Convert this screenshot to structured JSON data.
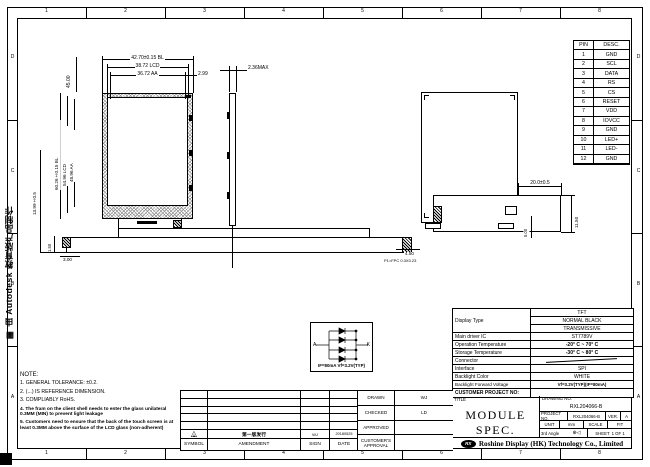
{
  "watermark": {
    "icon": "▦",
    "text": "由 Autodesk 教育版产品制作"
  },
  "zones": {
    "cols": [
      "1",
      "2",
      "3",
      "4",
      "5",
      "6",
      "7",
      "8"
    ],
    "rows": [
      "D",
      "C",
      "B",
      "A"
    ]
  },
  "pin_table": {
    "header": [
      "PIN",
      "DESC."
    ],
    "rows": [
      [
        "1",
        "GND"
      ],
      [
        "2",
        "SCL"
      ],
      [
        "3",
        "DATA"
      ],
      [
        "4",
        "RS"
      ],
      [
        "5",
        "CS"
      ],
      [
        "6",
        "RESET"
      ],
      [
        "7",
        "VDD"
      ],
      [
        "8",
        "IOVCC"
      ],
      [
        "9",
        "GND"
      ],
      [
        "10",
        "LED+"
      ],
      [
        "11",
        "LED-"
      ],
      [
        "12",
        "GND"
      ]
    ]
  },
  "dims": {
    "front_top_bl": "42.70±0.15 BL",
    "front_top_lcd": "38.72 LCD",
    "front_top_aa": "36.72 AA",
    "front_right_offset": "2.99",
    "front_topleft": "45.00",
    "front_left_bl": "60.26±0.15 BL",
    "front_left_lcd": "54.96 LCD",
    "front_left_aa": "48.96 AA",
    "front_farleft": "13.99±0.5",
    "fpc_150": "1.50",
    "fpc_300": "3.00",
    "side_thickness": "2.36MAX",
    "fpc_width": "4.50",
    "fpc_note": "P1=FPC 0.3X0.23",
    "back_tail_len": "20.0±0.5",
    "back_tail_w": "11.50",
    "back_foot": "5.00"
  },
  "circuit": {
    "anode": "A",
    "cathode": "K",
    "label": "IF=80mA  Vf=3.2V(TYP)"
  },
  "spec_table": {
    "display_type_label": "Display Type",
    "display_type_values": [
      "TFT",
      "NORMAL BLACK",
      "TRANSMISSIVE"
    ],
    "rows": [
      {
        "label": "Main driver IC",
        "value": "ST7789V"
      },
      {
        "label": "Operation Temperature",
        "value": "-20° C ~ 70° C"
      },
      {
        "label": "Storage Temperature",
        "value": "-30° C ~ 80° C"
      },
      {
        "label": "Connector",
        "value": ""
      },
      {
        "label": "Interface",
        "value": "SPI"
      },
      {
        "label": "Backlight Color",
        "value": "WHITE"
      },
      {
        "label": "Backlight Forward Voltage",
        "value": "Vf=3.2V(TYP)(IF=80mA)"
      }
    ],
    "customer_project_label": "CUSTOMER PROJECT NO:"
  },
  "title_block": {
    "title_label": "TITLE",
    "title": "MODULE SPEC.",
    "drawing_no_label": "DRAWING NO.",
    "drawing_no": "RXL204066-B",
    "project_no_label": "PROJECT NO.",
    "project_no": "RXL204066-B",
    "ver_label": "VER.",
    "ver": "A",
    "unit_label": "UNIT",
    "unit": "mm",
    "scale_label": "SCALE",
    "scale": "FIT",
    "angle_label": "3rd Angle",
    "angle_icon": "⊕◁",
    "sheet_label": "SHEET",
    "sheet": "1 OF 1",
    "logo": "RX",
    "company": "Roshine Display (HK) Technology Co., Limited"
  },
  "approval": {
    "drawn_label": "DRAWN",
    "drawn": "WJ",
    "checked_label": "CHECKED",
    "checked": "LD",
    "approved_label": "APPROVED",
    "approved": "",
    "customer_label": "CUSTOMER'S APPROVAL",
    "customer": ""
  },
  "amendment": {
    "headers": [
      "SYMBOL",
      "AMENDMENT",
      "SIGN",
      "DATE"
    ],
    "row": {
      "symbol_icon": "△",
      "symbol": "A",
      "text": "第一版发行",
      "sign": "WJ",
      "date": "20180525"
    }
  },
  "notes": {
    "heading": "NOTE:",
    "lines": [
      "1. GENERAL TOLERANCE: ±0.2.",
      "2. (...) IS REFERENCE DIMENSION.",
      "3. COMPLIABLY RoHS.",
      "4. The fram on the client shell needs to enter the glass unilateral 0.3MM (MIN) to prevent light leakage",
      "5. Customers need to ensure that the back of the touch screen is at least 0.3MM above the surface of the LCD glass (non-adherent)"
    ]
  }
}
